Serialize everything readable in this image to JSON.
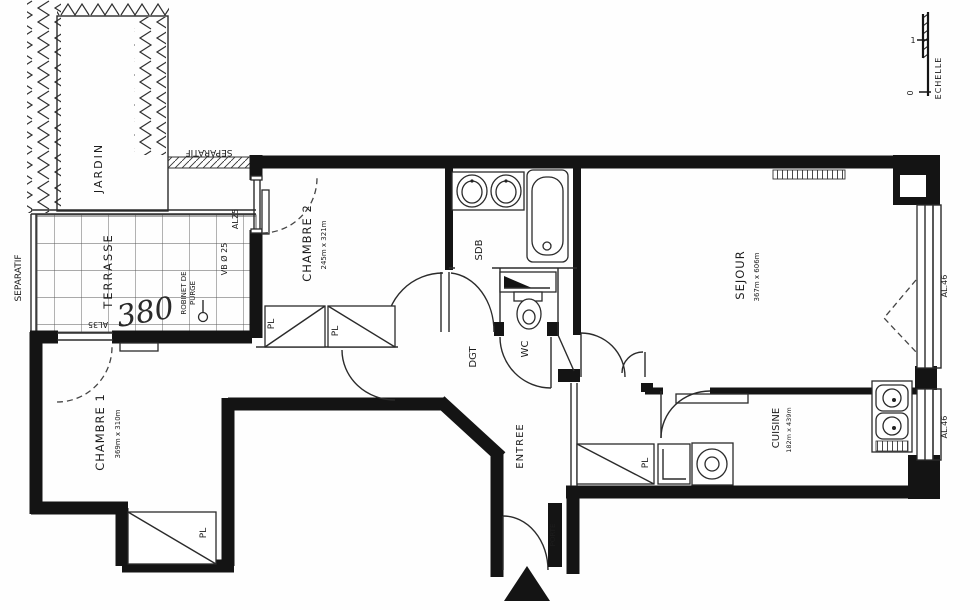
{
  "plan": {
    "outdoor": {
      "jardin": "JARDIN",
      "terrasse": "TERRASSE",
      "separatif_left": "SEPARATIF",
      "separatif_top": "SEPARATIF",
      "handwritten_dim": "380"
    },
    "rooms": {
      "chambre1": {
        "name": "CHAMBRE 1",
        "dims": "369m x 310m"
      },
      "chambre2": {
        "name": "CHAMBRE 2",
        "dims": "245m x 321m"
      },
      "sdb": {
        "name": "SDB"
      },
      "wc": {
        "name": "WC"
      },
      "dgt": {
        "name": "DGT"
      },
      "entree": {
        "name": "ENTREE"
      },
      "sejour": {
        "name": "SEJOUR",
        "dims": "367m x 606m"
      },
      "cuisine": {
        "name": "CUISINE",
        "dims": "182m x 439m"
      }
    },
    "labels": {
      "pl": "PL",
      "al25": "AL25",
      "al35": "AL35",
      "al46": "AL.46",
      "vb": "VB Ø 25",
      "robinet_1": "ROBINET DE",
      "robinet_2": "PURGE",
      "porte": "PORTE",
      "echelle": "ECHELLE",
      "scale_tick_1": "1",
      "scale_tick_0": "0"
    }
  }
}
